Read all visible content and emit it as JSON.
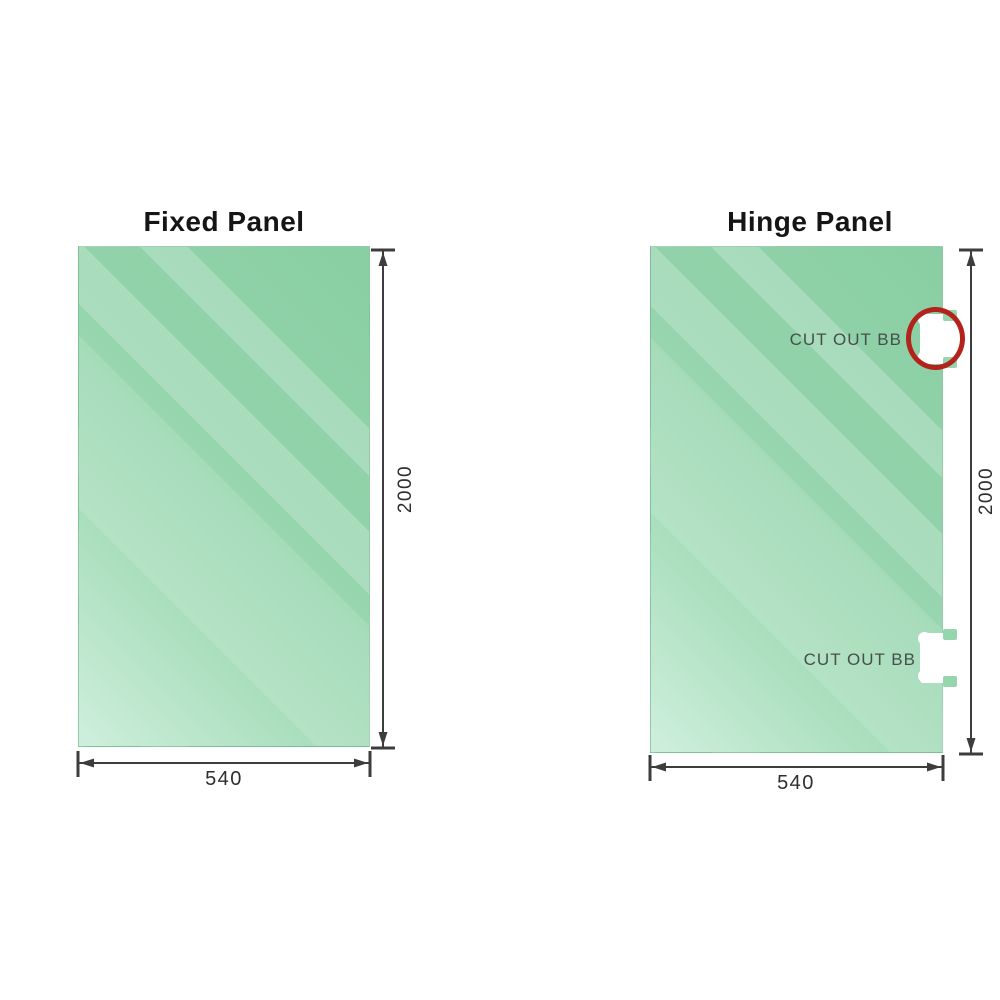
{
  "diagram": {
    "fixed_panel": {
      "title": "Fixed Panel",
      "width_label": "540",
      "height_label": "2000"
    },
    "hinge_panel": {
      "title": "Hinge Panel",
      "width_label": "540",
      "height_label": "2000",
      "cutout_top": {
        "label": "CUT OUT BB"
      },
      "cutout_bottom": {
        "label": "CUT OUT BB"
      }
    },
    "colors": {
      "glass_base": "#93d3ab",
      "glass_light": "#cfefdd",
      "dimension_line": "#3d3d3d",
      "highlight_ring": "#b3231c",
      "label_text": "#45504a",
      "title_text": "#151515"
    }
  }
}
